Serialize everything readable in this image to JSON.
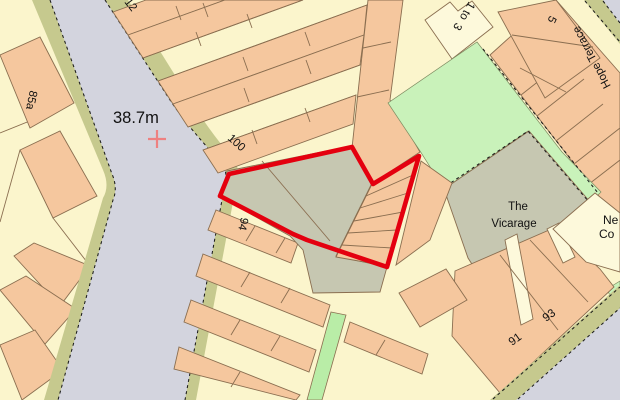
{
  "map": {
    "description": "large-scale street map extract with red site boundary",
    "labels": {
      "spot_height": "38.7m",
      "house_12": "12",
      "house_100": "100",
      "house_85a": "85a",
      "house_94": "94",
      "house_1to3_line1": "1 to",
      "house_1to3_line2": "3",
      "house_5": "5",
      "street_hope_terrace": "Hope Terrace",
      "vicarage_line1": "The",
      "vicarage_line2": "Vicarage",
      "house_91": "91",
      "house_93": "93",
      "partial_right_edge_line1": "Ne",
      "partial_right_edge_line2": "Co"
    },
    "colors": {
      "background_cream": "#fbf5cc",
      "building_peach": "#f5c79e",
      "building_cream": "#fdf9db",
      "outline_brown": "#8a6e50",
      "road_gray": "#d3d4de",
      "verge_olive": "#c6c98e",
      "green_space": "#c9f2ba",
      "footpath_green": "#b9eda7",
      "yard_gray": "#c6c7b1",
      "site_boundary_red": "#e4000f",
      "benchmark_cross_pink": "#ee8181"
    }
  }
}
